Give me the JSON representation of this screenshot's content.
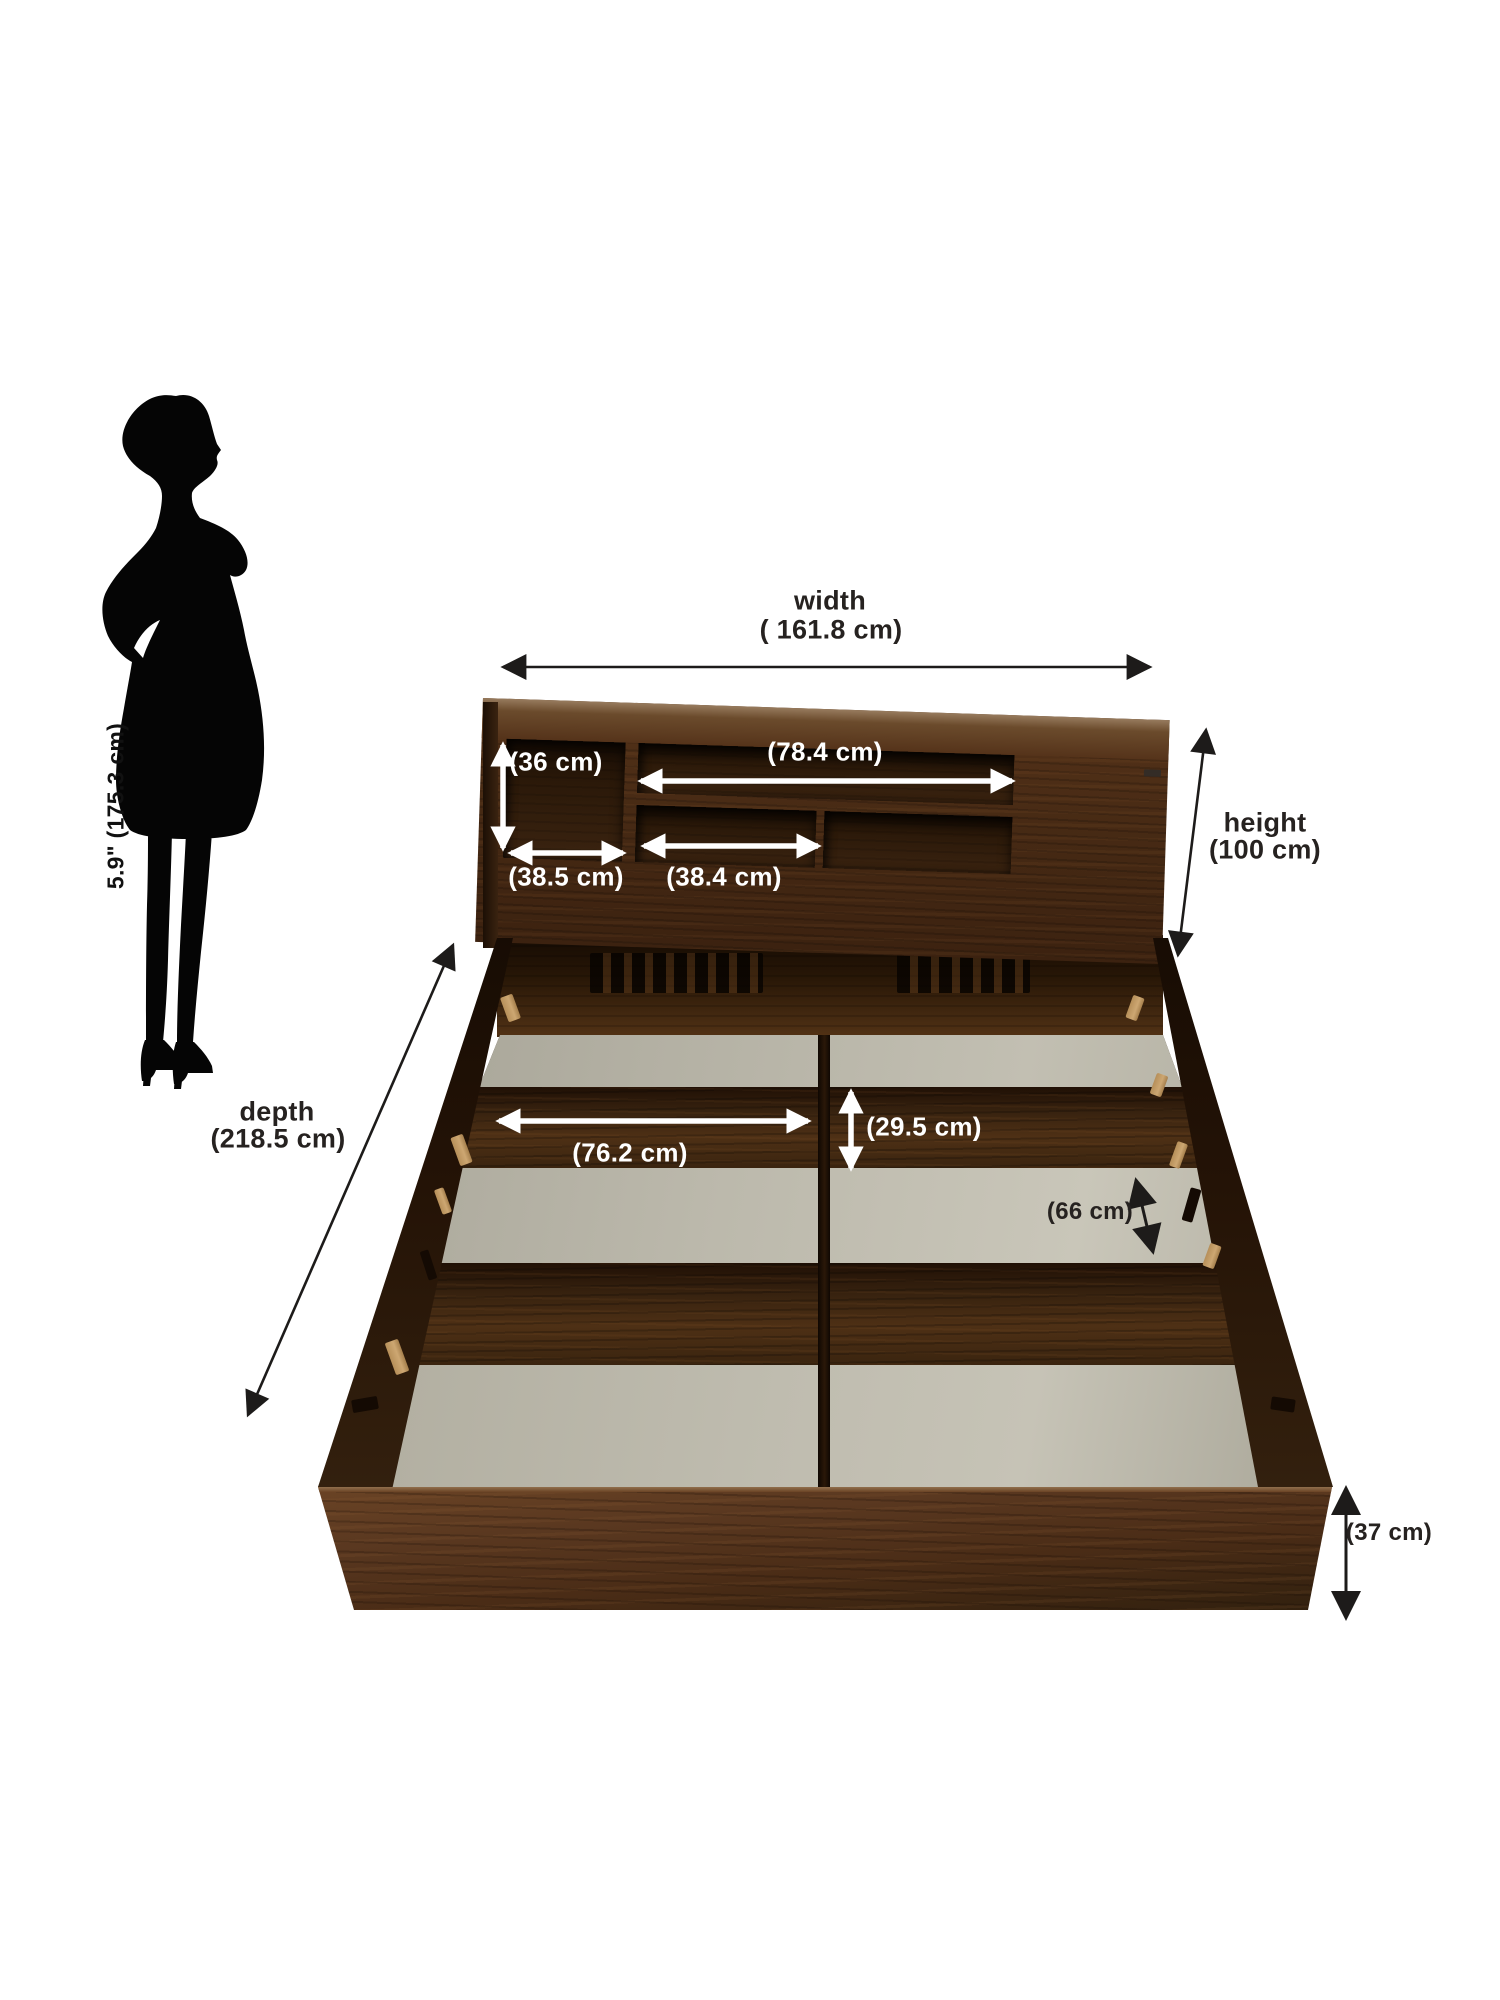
{
  "diagram": {
    "type": "furniture-dimension-diagram",
    "subject": "storage bed with shelf headboard",
    "person": {
      "height_label": "5.9\" (175.3 cm)"
    },
    "dimensions": [
      {
        "id": "width",
        "title": "width",
        "value": "( 161.8 cm)"
      },
      {
        "id": "height",
        "title": "height",
        "value": "(100 cm)"
      },
      {
        "id": "depth",
        "title": "depth",
        "value": "(218.5 cm)"
      },
      {
        "id": "headboard-shelf-height",
        "value": "(36 cm)"
      },
      {
        "id": "headboard-top-shelf-width",
        "value": "(78.4 cm)"
      },
      {
        "id": "headboard-left-shelf-width",
        "value": "(38.5 cm)"
      },
      {
        "id": "headboard-middle-shelf-width",
        "value": "(38.4 cm)"
      },
      {
        "id": "storage-compartment-width",
        "value": "(76.2 cm)"
      },
      {
        "id": "cross-beam-width",
        "value": "(29.5 cm)"
      },
      {
        "id": "storage-compartment-depth",
        "value": "(66 cm)"
      },
      {
        "id": "base-height",
        "value": "(37 cm)"
      }
    ],
    "colors": {
      "background": "#ffffff",
      "silhouette": "#050505",
      "annotation_dark": "#262220",
      "annotation_light": "#ffffff",
      "wood_dark": "#2c1a0b",
      "wood_mid": "#4a2d16",
      "wood_light": "#6b4526",
      "base_panel_gray": "#bab7aa",
      "peg_tan": "#c6a06b"
    }
  }
}
